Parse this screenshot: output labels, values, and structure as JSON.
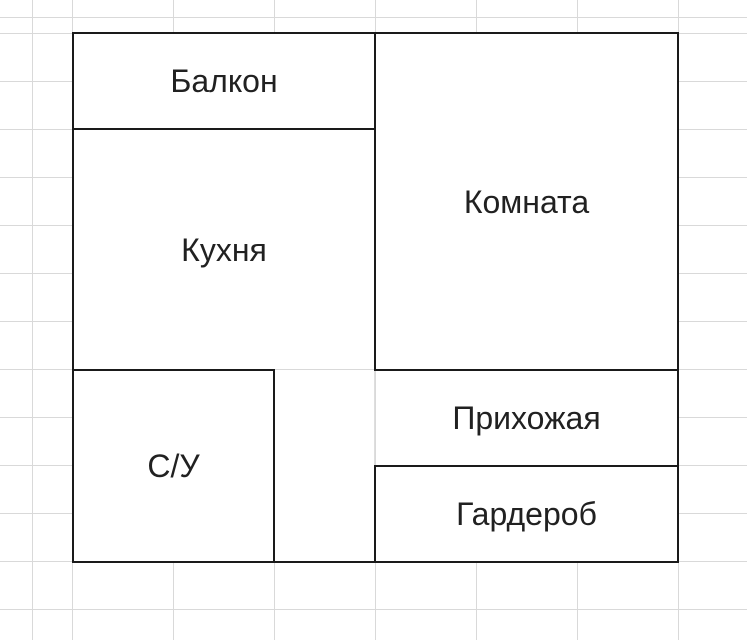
{
  "canvas": {
    "width": 747,
    "height": 640,
    "background": "#ffffff"
  },
  "grid": {
    "line_color": "#d9d9d9",
    "column_spacing": 101,
    "column_offset": 72,
    "row_spacing": 48,
    "row_offset": 33
  },
  "floorplan": {
    "wall_color": "#1a1a1a",
    "wall_thickness": 2,
    "label_color": "#212121",
    "label_font_size": 32,
    "rooms": [
      {
        "id": "balcony",
        "label": "Балкон",
        "x": 74,
        "y": 34,
        "w": 300,
        "h": 94
      },
      {
        "id": "kitchen",
        "label": "Кухня",
        "x": 74,
        "y": 130,
        "w": 300,
        "h": 239
      },
      {
        "id": "room",
        "label": "Комната",
        "x": 376,
        "y": 34,
        "w": 301,
        "h": 335
      },
      {
        "id": "bathroom",
        "label": "С/У",
        "x": 74,
        "y": 371,
        "w": 199,
        "h": 190
      },
      {
        "id": "hallway",
        "label": "Прихожая",
        "x": 376,
        "y": 371,
        "w": 301,
        "h": 94
      },
      {
        "id": "wardrobe",
        "label": "Гардероб",
        "x": 376,
        "y": 467,
        "w": 301,
        "h": 94
      }
    ],
    "corridor": {
      "id": "corridor",
      "x": 275,
      "y": 371,
      "w": 99,
      "h": 190
    },
    "corridor_gridline": {
      "x": 374,
      "y": 371,
      "w": 1,
      "h": 94
    },
    "walls": [
      {
        "id": "outer-top",
        "x": 72,
        "y": 32,
        "w": 607,
        "h": 2
      },
      {
        "id": "outer-bottom",
        "x": 72,
        "y": 561,
        "w": 607,
        "h": 2
      },
      {
        "id": "outer-left",
        "x": 72,
        "y": 32,
        "w": 2,
        "h": 531
      },
      {
        "id": "outer-right",
        "x": 677,
        "y": 32,
        "w": 2,
        "h": 531
      },
      {
        "id": "balcony-bottom",
        "x": 72,
        "y": 128,
        "w": 304,
        "h": 2
      },
      {
        "id": "kitchen-room-divider",
        "x": 374,
        "y": 32,
        "w": 2,
        "h": 339
      },
      {
        "id": "hallway-top",
        "x": 374,
        "y": 369,
        "w": 305,
        "h": 2
      },
      {
        "id": "bathroom-top",
        "x": 72,
        "y": 369,
        "w": 203,
        "h": 2
      },
      {
        "id": "bathroom-right",
        "x": 273,
        "y": 369,
        "w": 2,
        "h": 194
      },
      {
        "id": "wardrobe-top",
        "x": 374,
        "y": 465,
        "w": 305,
        "h": 2
      },
      {
        "id": "wardrobe-left",
        "x": 374,
        "y": 465,
        "w": 2,
        "h": 98
      }
    ]
  }
}
